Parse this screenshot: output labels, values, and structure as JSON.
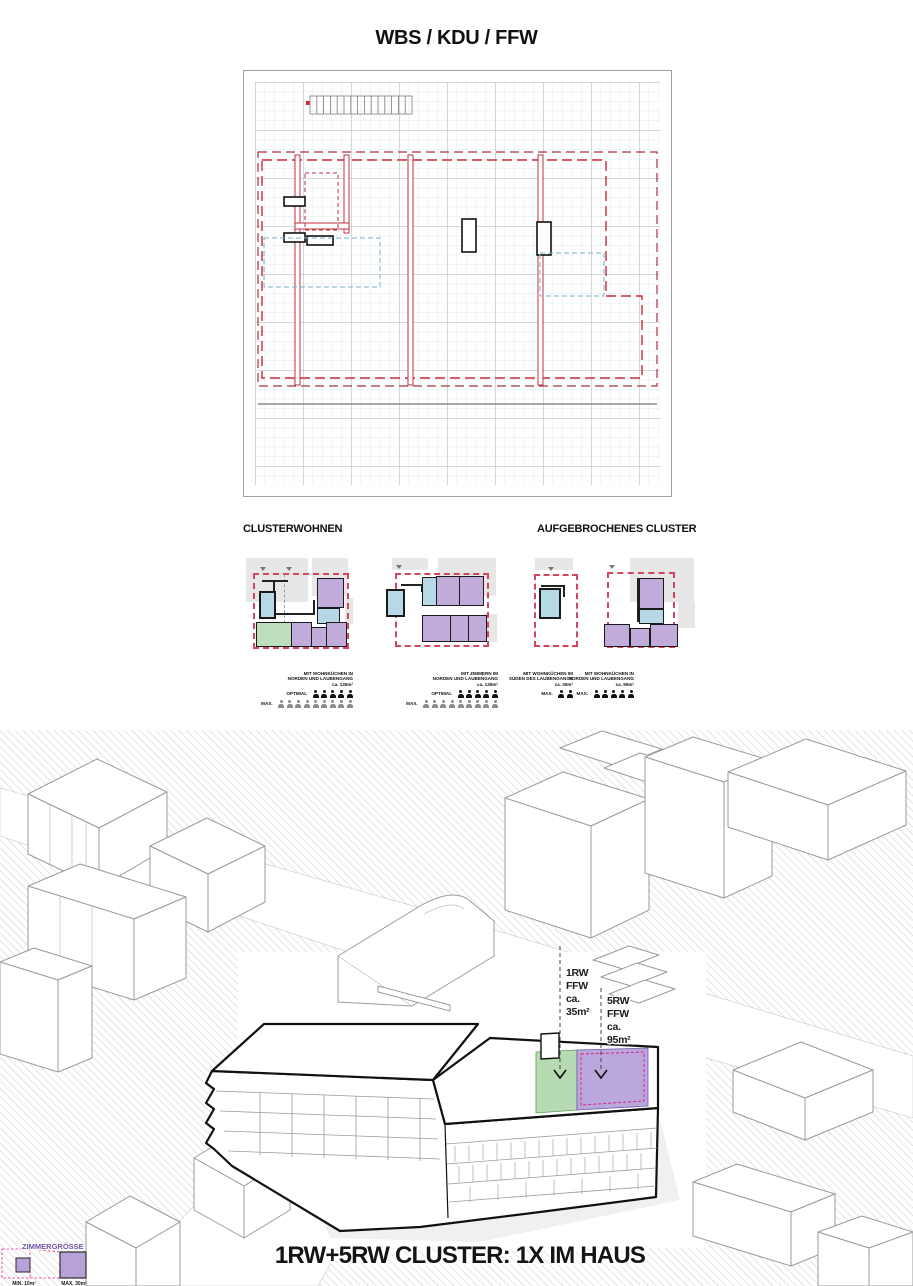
{
  "page": {
    "title": "WBS / KDU / FFW"
  },
  "clusters": {
    "heading_left": "CLUSTERWOHNEN",
    "heading_right": "AUFGEBROCHENES CLUSTER",
    "items": [
      {
        "note_line1": "MIT WOHNKÜCHEN IN",
        "note_line2": "NORDEN UND LAUBENGANG",
        "note_line3": "ca. 135m²",
        "optimal_label": "OPTIMAL",
        "optimal_count": 5,
        "max_label": "MAX.",
        "max_count": 9
      },
      {
        "note_line1": "MIT ZIMMERN IM",
        "note_line2": "NORDEN UND LAUBENGANG",
        "note_line3": "ca. 135m²",
        "optimal_label": "OPTIMAL",
        "optimal_count": 5,
        "max_label": "MAX.",
        "max_count": 9
      },
      {
        "note_line1": "MIT WOHNKÜCHEN IM",
        "note_line2": "SÜDEN DES LAUBENGANGS",
        "note_line3": "ca. 35m²",
        "max_label": "MAX.",
        "max_count": 2
      },
      {
        "note_line1": "MIT WOHNKÜCHEN IN",
        "note_line2": "NORDEN UND LAUBENGANG",
        "note_line3": "ca. 95m²",
        "max_label": "MAX.",
        "max_count": 5
      }
    ]
  },
  "axon": {
    "label_1rw_line1": "1RW",
    "label_1rw_line2": "FFW",
    "label_1rw_line3": "ca.",
    "label_1rw_line4": "35m²",
    "label_5rw_line1": "5RW",
    "label_5rw_line2": "FFW",
    "label_5rw_line3": "ca.",
    "label_5rw_line4": "95m²",
    "caption": "1RW+5RW CLUSTER: 1X IM HAUS",
    "legend_title": "ZIMMERGRÖSSE",
    "legend_min": "MIN. 10m²",
    "legend_max": "MAX. 30m²"
  },
  "colors": {
    "accent_red": "#cc2936",
    "plan_red_dashed": "#d5455f",
    "room_purple": "#c1abdb",
    "room_green": "#bedfbc",
    "room_blue": "#b6d8e7",
    "highlight_magenta": "#e0218a",
    "grid_teal": "#aed0d8"
  }
}
